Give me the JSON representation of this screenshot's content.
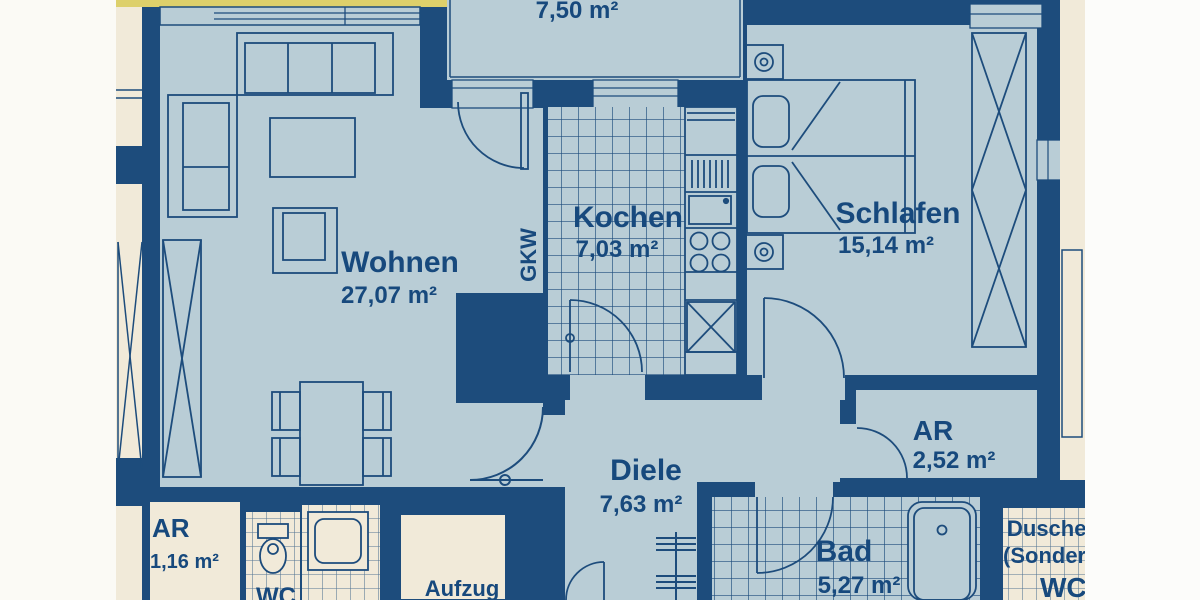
{
  "plan": {
    "type": "apartment-floor-plan",
    "colors": {
      "wall_navy": "#1d4c7c",
      "room_blue": "#b9cdd6",
      "neighbor_cream": "#f1ead9",
      "highlight_yellow": "#ddd06b",
      "paper_white": "#fbfaf5",
      "label_navy": "#17497d"
    },
    "rooms": {
      "balcony": {
        "area": "7,50 m²"
      },
      "wohnen": {
        "name": "Wohnen",
        "area": "27,07 m²"
      },
      "kochen": {
        "name": "Kochen",
        "area": "7,03 m²"
      },
      "schlafen": {
        "name": "Schlafen",
        "area": "15,14 m²"
      },
      "diele": {
        "name": "Diele",
        "area": "7,63 m²"
      },
      "bad": {
        "name": "Bad",
        "area": "5,27 m²"
      },
      "ar": {
        "name": "AR",
        "area": "2,52 m²"
      },
      "gkw": {
        "label": "GKW"
      }
    },
    "common": {
      "aufzug": {
        "label": "Aufzug"
      }
    },
    "neighbor_left": {
      "ar": {
        "name": "AR",
        "area": "1,16 m²"
      },
      "wc": {
        "label": "WC"
      }
    },
    "neighbor_right": {
      "dusche_line1": "Dusche",
      "dusche_line2": "(Sonderw",
      "wc": "WC"
    }
  }
}
